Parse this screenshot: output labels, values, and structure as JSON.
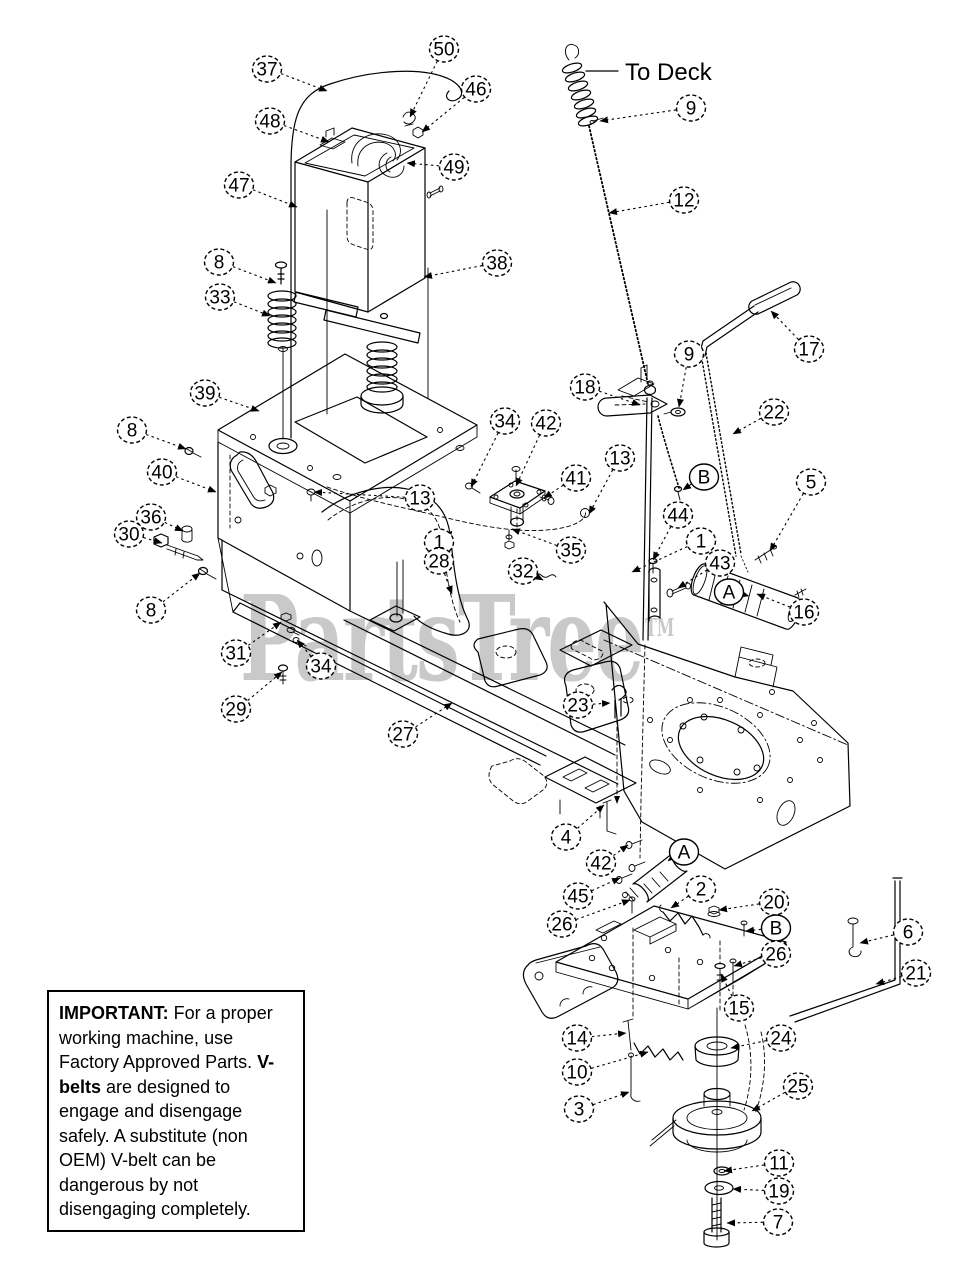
{
  "labels": {
    "to_deck": "To Deck"
  },
  "watermark": {
    "text": "PartsTree",
    "tm": "TM",
    "color": "#c9c9c9"
  },
  "note_box": {
    "segments": [
      {
        "text": "IMPORTANT:",
        "bold": true
      },
      {
        "text": " For a proper working machine, use Factory Approved Parts. ",
        "bold": false
      },
      {
        "text": "V-belts",
        "bold": true
      },
      {
        "text": " are designed to engage and disengage safely. A substitute (non OEM) V-belt can be dangerous by not disengaging completely.",
        "bold": false
      }
    ]
  },
  "diagram": {
    "line_color": "#000000",
    "callouts": [
      {
        "label": "37",
        "x": 267,
        "y": 69,
        "tx": 327,
        "ty": 91,
        "letter": false
      },
      {
        "label": "50",
        "x": 444,
        "y": 49,
        "tx": 410,
        "ty": 117,
        "letter": false
      },
      {
        "label": "46",
        "x": 476,
        "y": 89,
        "tx": 422,
        "ty": 132,
        "letter": false
      },
      {
        "label": "48",
        "x": 270,
        "y": 121,
        "tx": 329,
        "ty": 142,
        "letter": false
      },
      {
        "label": "49",
        "x": 454,
        "y": 167,
        "tx": 407,
        "ty": 163,
        "letter": false
      },
      {
        "label": "47",
        "x": 239,
        "y": 185,
        "tx": 297,
        "ty": 207,
        "letter": false
      },
      {
        "label": "38",
        "x": 497,
        "y": 263,
        "tx": 424,
        "ty": 277,
        "letter": false
      },
      {
        "label": "9",
        "x": 691,
        "y": 108,
        "tx": 600,
        "ty": 121,
        "letter": false
      },
      {
        "label": "12",
        "x": 684,
        "y": 200,
        "tx": 609,
        "ty": 213,
        "letter": false
      },
      {
        "label": "8",
        "x": 219,
        "y": 262,
        "tx": 276,
        "ty": 283,
        "letter": false
      },
      {
        "label": "33",
        "x": 220,
        "y": 297,
        "tx": 270,
        "ty": 316,
        "letter": false
      },
      {
        "label": "17",
        "x": 809,
        "y": 349,
        "tx": 771,
        "ty": 311,
        "letter": false
      },
      {
        "label": "9",
        "x": 689,
        "y": 354,
        "tx": 679,
        "ty": 407,
        "letter": false
      },
      {
        "label": "18",
        "x": 585,
        "y": 387,
        "tx": 640,
        "ty": 405,
        "letter": false
      },
      {
        "label": "22",
        "x": 774,
        "y": 412,
        "tx": 733,
        "ty": 434,
        "letter": false
      },
      {
        "label": "39",
        "x": 205,
        "y": 393,
        "tx": 259,
        "ty": 411,
        "letter": false
      },
      {
        "label": "34",
        "x": 505,
        "y": 421,
        "tx": 471,
        "ty": 487,
        "letter": false
      },
      {
        "label": "42",
        "x": 546,
        "y": 423,
        "tx": 516,
        "ty": 486,
        "letter": false
      },
      {
        "label": "8",
        "x": 132,
        "y": 430,
        "tx": 186,
        "ty": 449,
        "letter": false
      },
      {
        "label": "13",
        "x": 620,
        "y": 458,
        "tx": 589,
        "ty": 514,
        "letter": false
      },
      {
        "label": "41",
        "x": 576,
        "y": 478,
        "tx": 544,
        "ty": 498,
        "letter": false
      },
      {
        "label": "B",
        "x": 704,
        "y": 477,
        "tx": 683,
        "ty": 490,
        "letter": true
      },
      {
        "label": "5",
        "x": 811,
        "y": 482,
        "tx": 770,
        "ty": 551,
        "letter": false
      },
      {
        "label": "40",
        "x": 162,
        "y": 472,
        "tx": 216,
        "ty": 492,
        "letter": false
      },
      {
        "label": "36",
        "x": 151,
        "y": 517,
        "tx": 183,
        "ty": 531,
        "letter": false
      },
      {
        "label": "30",
        "x": 129,
        "y": 534,
        "tx": 162,
        "ty": 543,
        "letter": false
      },
      {
        "label": "44",
        "x": 678,
        "y": 515,
        "tx": 653,
        "ty": 560,
        "letter": false
      },
      {
        "label": "13",
        "x": 420,
        "y": 498,
        "tx": 314,
        "ty": 492,
        "letter": false
      },
      {
        "label": "1",
        "x": 439,
        "y": 542,
        "tx": 452,
        "ty": 531,
        "letter": false
      },
      {
        "label": "28",
        "x": 439,
        "y": 561,
        "tx": 452,
        "ty": 594,
        "letter": false
      },
      {
        "label": "35",
        "x": 571,
        "y": 550,
        "tx": 512,
        "ty": 529,
        "letter": false
      },
      {
        "label": "32",
        "x": 523,
        "y": 571,
        "tx": 543,
        "ty": 580,
        "letter": false
      },
      {
        "label": "1",
        "x": 701,
        "y": 541,
        "tx": 632,
        "ty": 572,
        "letter": false
      },
      {
        "label": "43",
        "x": 720,
        "y": 563,
        "tx": 678,
        "ty": 588,
        "letter": false
      },
      {
        "label": "A",
        "x": 729,
        "y": 592,
        "tx": 749,
        "ty": 596,
        "letter": true
      },
      {
        "label": "16",
        "x": 804,
        "y": 612,
        "tx": 757,
        "ty": 594,
        "letter": false
      },
      {
        "label": "8",
        "x": 151,
        "y": 610,
        "tx": 200,
        "ty": 573,
        "letter": false
      },
      {
        "label": "31",
        "x": 236,
        "y": 653,
        "tx": 281,
        "ty": 622,
        "letter": false
      },
      {
        "label": "34",
        "x": 321,
        "y": 666,
        "tx": 297,
        "ty": 640,
        "letter": false
      },
      {
        "label": "29",
        "x": 236,
        "y": 709,
        "tx": 282,
        "ty": 672,
        "letter": false
      },
      {
        "label": "23",
        "x": 578,
        "y": 705,
        "tx": 610,
        "ty": 703,
        "letter": false
      },
      {
        "label": "27",
        "x": 403,
        "y": 734,
        "tx": 452,
        "ty": 703,
        "letter": false
      },
      {
        "label": "4",
        "x": 566,
        "y": 837,
        "tx": 604,
        "ty": 805,
        "letter": false
      },
      {
        "label": "42",
        "x": 601,
        "y": 863,
        "tx": 628,
        "ty": 845,
        "letter": false
      },
      {
        "label": "A",
        "x": 684,
        "y": 852,
        "tx": 668,
        "ty": 861,
        "letter": true
      },
      {
        "label": "45",
        "x": 578,
        "y": 896,
        "tx": 620,
        "ty": 878,
        "letter": false
      },
      {
        "label": "2",
        "x": 701,
        "y": 889,
        "tx": 671,
        "ty": 908,
        "letter": false
      },
      {
        "label": "20",
        "x": 774,
        "y": 902,
        "tx": 719,
        "ty": 910,
        "letter": false
      },
      {
        "label": "B",
        "x": 776,
        "y": 928,
        "tx": 746,
        "ty": 931,
        "letter": true
      },
      {
        "label": "26",
        "x": 562,
        "y": 924,
        "tx": 630,
        "ty": 900,
        "letter": false
      },
      {
        "label": "26",
        "x": 776,
        "y": 954,
        "tx": 734,
        "ty": 966,
        "letter": false
      },
      {
        "label": "6",
        "x": 908,
        "y": 932,
        "tx": 860,
        "ty": 943,
        "letter": false
      },
      {
        "label": "21",
        "x": 916,
        "y": 973,
        "tx": 876,
        "ty": 984,
        "letter": false
      },
      {
        "label": "15",
        "x": 739,
        "y": 1008,
        "tx": 721,
        "ty": 974,
        "letter": false
      },
      {
        "label": "14",
        "x": 577,
        "y": 1038,
        "tx": 626,
        "ty": 1033,
        "letter": false
      },
      {
        "label": "10",
        "x": 577,
        "y": 1072,
        "tx": 648,
        "ty": 1052,
        "letter": false
      },
      {
        "label": "3",
        "x": 579,
        "y": 1109,
        "tx": 629,
        "ty": 1092,
        "letter": false
      },
      {
        "label": "24",
        "x": 781,
        "y": 1038,
        "tx": 731,
        "ty": 1048,
        "letter": false
      },
      {
        "label": "25",
        "x": 798,
        "y": 1086,
        "tx": 752,
        "ty": 1111,
        "letter": false
      },
      {
        "label": "11",
        "x": 779,
        "y": 1163,
        "tx": 724,
        "ty": 1171,
        "letter": false
      },
      {
        "label": "19",
        "x": 779,
        "y": 1191,
        "tx": 733,
        "ty": 1189,
        "letter": false
      },
      {
        "label": "7",
        "x": 778,
        "y": 1222,
        "tx": 727,
        "ty": 1223,
        "letter": false
      }
    ]
  }
}
